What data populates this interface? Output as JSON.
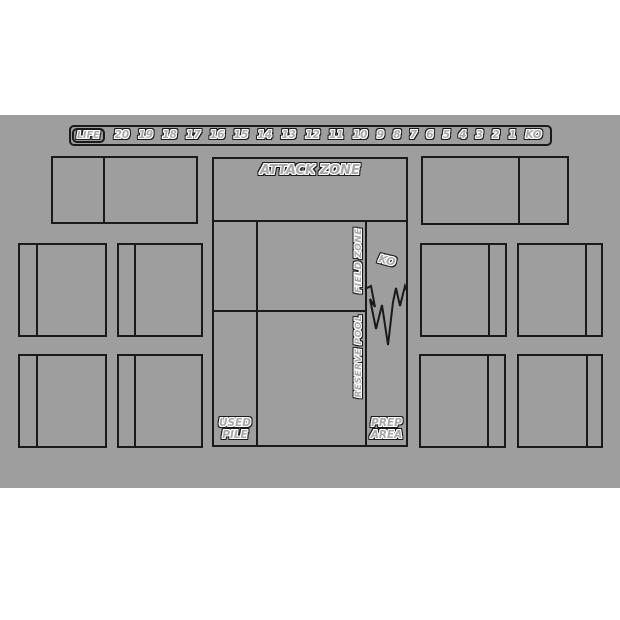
{
  "mat": {
    "background": "#9e9e9e",
    "line_color": "#1a1a1a"
  },
  "life_track": {
    "label": "LIFE",
    "values": [
      "20",
      "19",
      "18",
      "17",
      "16",
      "15",
      "14",
      "13",
      "12",
      "11",
      "10",
      "9",
      "8",
      "7",
      "6",
      "5",
      "4",
      "3",
      "2",
      "1",
      "KO"
    ]
  },
  "zones": {
    "attack_zone_label": "ATTACK ZONE",
    "field_zone_label": "FIELD ZONE",
    "reserve_pool_label": "RESERVE POOL",
    "ko_label": "KO",
    "used_pile_label": "USED\nPILE",
    "prep_area_label": "PREP\nAREA"
  }
}
